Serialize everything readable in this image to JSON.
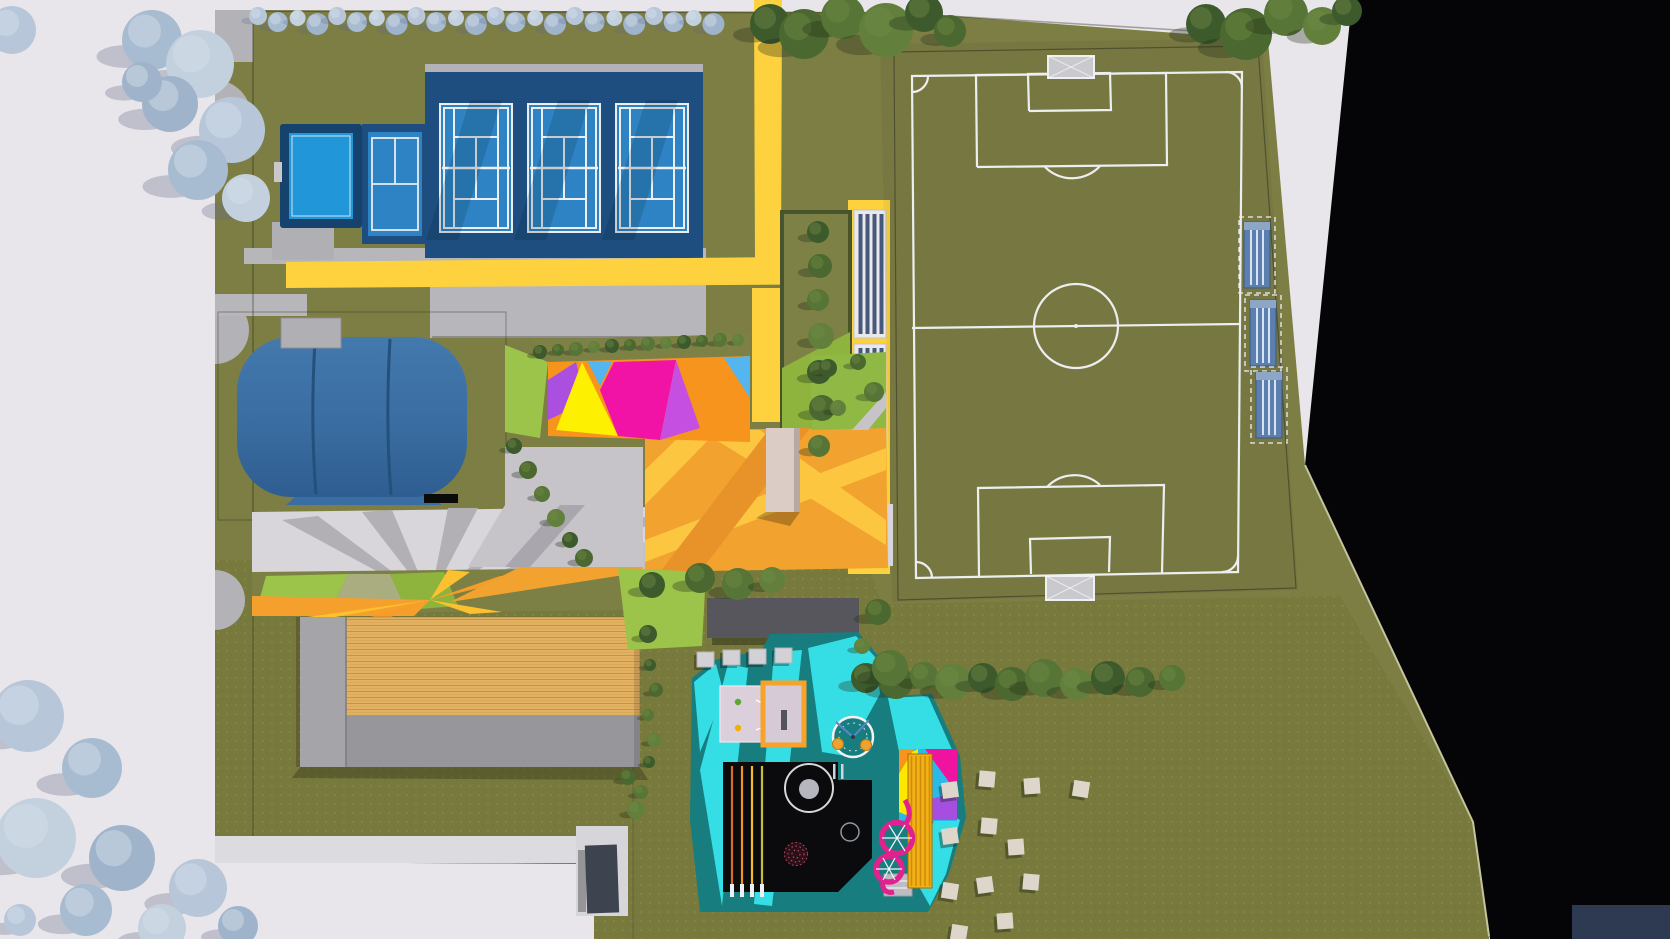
{
  "palette": {
    "paper": "#e8e6ea",
    "void": "#050507",
    "navy_block": "#2d3a52",
    "grass": "#7d7e44",
    "meadow": "#777a3c",
    "path_yellow": "#fdd23e",
    "concrete": "#b7b6ba",
    "concrete_light": "#d8d6da",
    "court_platform": "#1d4e7f",
    "court_blue": "#2d83c4",
    "pool_blue": "#2196d8",
    "line_white": "#edeef0",
    "amber": "#f2a22e",
    "amber_light": "#fdc640",
    "teal": "#177d7f",
    "cyan": "#35dde4",
    "play_black": "#0b0b0e",
    "pink_slide": "#e0218e",
    "tower_yellow": "#f2b118",
    "wood_roof": "#e2b164",
    "kiosk": "#dcccc6",
    "dome_blue_hi": "#4379ad",
    "dome_blue_lo": "#2e5d91",
    "triangle_magenta": "#f013a5",
    "triangle_yellow": "#fdf000",
    "triangle_purple": "#ab4fe0",
    "triangle_cyan": "#55b5ef",
    "triangle_orange": "#f7941e",
    "bleacher_stripe": "#46597c",
    "lavender_deck": "#dacfdb",
    "picnic": "#ded6ca"
  },
  "objects": {
    "tennis_courts_count": 3,
    "practice_court_count": 1,
    "pool_count": 1,
    "air_dome_count": 1,
    "soccer_field_count": 1,
    "dugouts_count": 3,
    "bleacher_segments": 2,
    "playground_items": [
      "sand-deck",
      "sandbox",
      "carousel",
      "black-play-structure",
      "climb-dome",
      "spiral-slide",
      "tower-slide"
    ],
    "picnic_blankets_count": 12
  },
  "layout_data": {
    "courts_x": [
      440,
      528,
      616
    ],
    "dugouts": [
      [
        1244,
        222
      ],
      [
        1250,
        300
      ],
      [
        1256,
        372
      ]
    ],
    "stepping_pads": [
      [
        697,
        652
      ],
      [
        723,
        650
      ],
      [
        749,
        649
      ],
      [
        775,
        648
      ]
    ],
    "picnic": [
      [
        950,
        790
      ],
      [
        987,
        779
      ],
      [
        1032,
        786
      ],
      [
        1081,
        789
      ],
      [
        950,
        836
      ],
      [
        989,
        826
      ],
      [
        1016,
        847
      ],
      [
        950,
        891
      ],
      [
        985,
        885
      ],
      [
        1031,
        882
      ],
      [
        1005,
        921
      ],
      [
        959,
        933
      ]
    ],
    "blue_row": {
      "start": 258,
      "step": 19.8,
      "count": 24,
      "cys": [
        16,
        22,
        18,
        24
      ],
      "rs": [
        9,
        10,
        8,
        11
      ]
    },
    "blue_colors": [
      "#b7c7d9",
      "#a8bcd1",
      "#c3d0de",
      "#9fb4cb"
    ],
    "green_colors": [
      "#3c5a2c",
      "#4a682f",
      "#567536",
      "#62803c"
    ],
    "green_top_left": [
      [
        770,
        24,
        20
      ],
      [
        804,
        34,
        25
      ],
      [
        843,
        17,
        22
      ],
      [
        886,
        30,
        27
      ],
      [
        924,
        13,
        19
      ],
      [
        950,
        31,
        16
      ]
    ],
    "green_top_right": [
      [
        1206,
        24,
        20
      ],
      [
        1246,
        34,
        26
      ],
      [
        1286,
        14,
        22
      ],
      [
        1322,
        26,
        19
      ],
      [
        1347,
        11,
        15
      ]
    ],
    "blue_nw": [
      [
        12,
        30,
        24
      ],
      [
        152,
        40,
        30
      ],
      [
        200,
        64,
        34
      ],
      [
        170,
        104,
        28
      ],
      [
        232,
        130,
        33
      ],
      [
        198,
        170,
        30
      ],
      [
        246,
        198,
        24
      ],
      [
        142,
        82,
        20
      ]
    ],
    "blue_sw": [
      [
        28,
        716,
        36
      ],
      [
        92,
        768,
        30
      ],
      [
        36,
        838,
        40
      ],
      [
        122,
        858,
        33
      ],
      [
        198,
        888,
        29
      ],
      [
        86,
        910,
        26
      ],
      [
        162,
        928,
        24
      ],
      [
        238,
        926,
        20
      ],
      [
        20,
        920,
        16
      ]
    ],
    "meadow_row": [
      [
        866,
        678,
        15
      ],
      [
        896,
        682,
        17
      ],
      [
        924,
        676,
        14
      ],
      [
        953,
        682,
        18
      ],
      [
        983,
        678,
        15
      ],
      [
        1012,
        684,
        17
      ],
      [
        1044,
        678,
        19
      ],
      [
        1076,
        684,
        16
      ],
      [
        1108,
        678,
        17
      ],
      [
        1140,
        682,
        15
      ],
      [
        1172,
        678,
        13
      ]
    ],
    "garden_column": [
      [
        818,
        232,
        11
      ],
      [
        820,
        266,
        12
      ],
      [
        818,
        300,
        11
      ],
      [
        821,
        336,
        13
      ],
      [
        819,
        372,
        12
      ],
      [
        822,
        408,
        13
      ],
      [
        819,
        446,
        11
      ]
    ],
    "hedge_top_bushes": [
      [
        540,
        352,
        7
      ],
      [
        558,
        350,
        6
      ],
      [
        576,
        349,
        7
      ],
      [
        594,
        347,
        6
      ],
      [
        612,
        346,
        7
      ],
      [
        630,
        345,
        6
      ],
      [
        648,
        344,
        7
      ],
      [
        666,
        343,
        6
      ],
      [
        684,
        342,
        7
      ],
      [
        702,
        341,
        6
      ],
      [
        720,
        340,
        7
      ],
      [
        738,
        340,
        6
      ]
    ],
    "hedge_left_bushes": [
      [
        514,
        446,
        8
      ],
      [
        528,
        470,
        9
      ],
      [
        542,
        494,
        8
      ],
      [
        556,
        518,
        9
      ],
      [
        570,
        540,
        8
      ],
      [
        584,
        558,
        9
      ]
    ],
    "lawn_bushes": [
      [
        828,
        368,
        9
      ],
      [
        858,
        362,
        8
      ],
      [
        874,
        392,
        10
      ],
      [
        838,
        408,
        8
      ]
    ],
    "pergola_trees": [
      [
        652,
        585,
        13
      ],
      [
        700,
        578,
        15
      ],
      [
        738,
        584,
        16
      ],
      [
        772,
        580,
        13
      ],
      [
        648,
        634,
        9
      ],
      [
        878,
        612,
        13
      ],
      [
        890,
        668,
        18
      ],
      [
        862,
        646,
        8
      ]
    ],
    "building_side_bushes": [
      [
        650,
        665,
        6
      ],
      [
        656,
        690,
        7
      ],
      [
        648,
        715,
        6
      ],
      [
        654,
        740,
        7
      ],
      [
        649,
        762,
        6
      ],
      [
        628,
        777,
        8
      ],
      [
        641,
        792,
        7
      ],
      [
        636,
        810,
        9
      ]
    ]
  }
}
